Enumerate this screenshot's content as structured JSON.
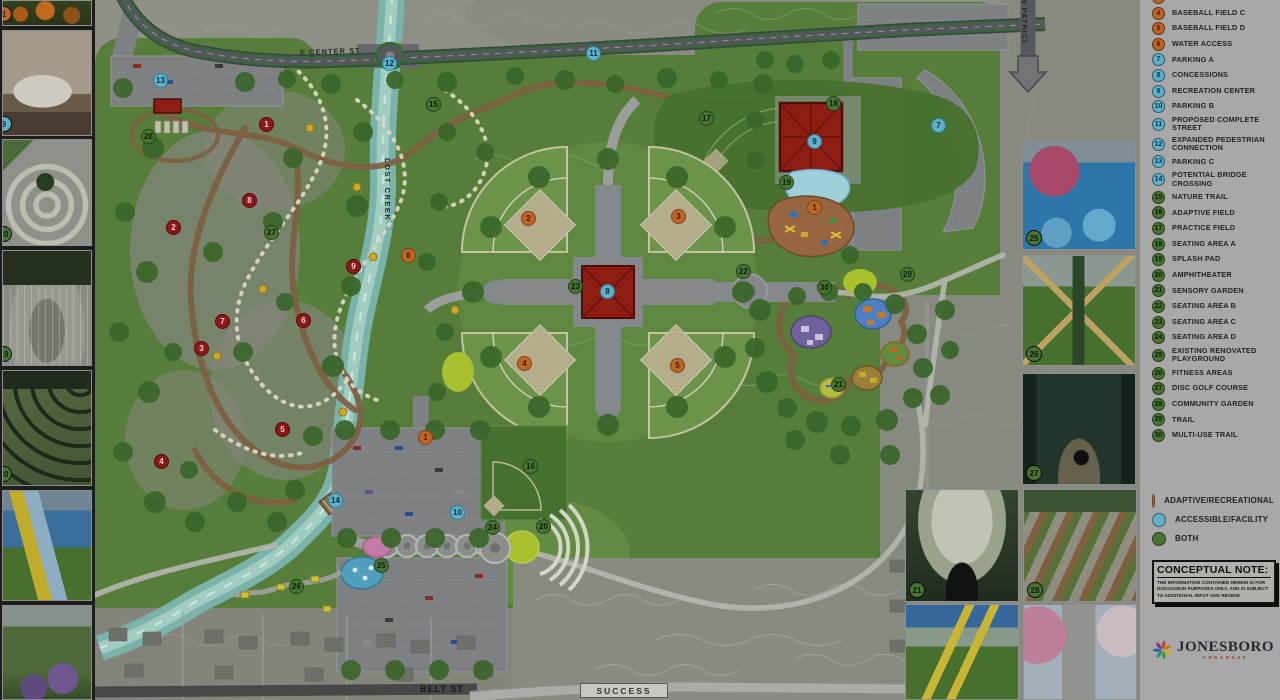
{
  "legend": {
    "items": [
      {
        "num": "3",
        "label": "BASEBALL FIELD B",
        "type": "adaptive"
      },
      {
        "num": "4",
        "label": "BASEBALL FIELD C",
        "type": "adaptive"
      },
      {
        "num": "5",
        "label": "BASEBALL FIELD D",
        "type": "adaptive"
      },
      {
        "num": "6",
        "label": "WATER ACCESS",
        "type": "adaptive"
      },
      {
        "num": "7",
        "label": "PARKING A",
        "type": "accessible"
      },
      {
        "num": "8",
        "label": "CONCESSIONS",
        "type": "accessible"
      },
      {
        "num": "9",
        "label": "RECREATION CENTER",
        "type": "accessible"
      },
      {
        "num": "10",
        "label": "PARKING B",
        "type": "accessible"
      },
      {
        "num": "11",
        "label": "PROPOSED COMPLETE STREET",
        "type": "accessible"
      },
      {
        "num": "12",
        "label": "EXPANDED PEDESTRIAN CONNECTION",
        "type": "accessible"
      },
      {
        "num": "13",
        "label": "PARKING C",
        "type": "accessible"
      },
      {
        "num": "14",
        "label": "POTENTIAL BRIDGE CROSSING",
        "type": "accessible"
      },
      {
        "num": "15",
        "label": "NATURE TRAIL",
        "type": "both"
      },
      {
        "num": "16",
        "label": "ADAPTIVE FIELD",
        "type": "both"
      },
      {
        "num": "17",
        "label": "PRACTICE FIELD",
        "type": "both"
      },
      {
        "num": "18",
        "label": "SEATING AREA A",
        "type": "both"
      },
      {
        "num": "19",
        "label": "SPLASH PAD",
        "type": "both"
      },
      {
        "num": "20",
        "label": "AMPHITHEATER",
        "type": "both"
      },
      {
        "num": "21",
        "label": "SENSORY GARDEN",
        "type": "both"
      },
      {
        "num": "22",
        "label": "SEATING AREA B",
        "type": "both"
      },
      {
        "num": "23",
        "label": "SEATING AREA C",
        "type": "both"
      },
      {
        "num": "24",
        "label": "SEATING AREA D",
        "type": "both"
      },
      {
        "num": "25",
        "label": "EXISTING RENOVATED PLAYGROUND",
        "type": "both"
      },
      {
        "num": "26",
        "label": "FITNESS AREAS",
        "type": "both"
      },
      {
        "num": "27",
        "label": "DISC GOLF COURSE",
        "type": "both"
      },
      {
        "num": "28",
        "label": "COMMUNITY GARDEN",
        "type": "both"
      },
      {
        "num": "29",
        "label": "TRAIL",
        "type": "both"
      },
      {
        "num": "30",
        "label": "MULTI-USE TRAIL",
        "type": "both"
      }
    ],
    "key": [
      {
        "label": "ADAPTIVE/RECREATIONAL",
        "color": "#bf6626",
        "type": "adaptive"
      },
      {
        "label": "ACCESSIBLE/FACILITY",
        "color": "#5fb0ca",
        "type": "accessible"
      },
      {
        "label": "BOTH",
        "color": "#4a7433",
        "type": "both"
      }
    ],
    "note": {
      "title": "CONCEPTUAL NOTE:",
      "body": "THE INFORMATION CONTAINED HEREIN IS FOR DISCUSSION PURPOSES ONLY, AND IS SUBJECT TO ADDITIONAL INPUT AND REVIEW"
    },
    "logo": {
      "name": "JONESBORO",
      "sub": "ARKANSAS"
    }
  },
  "map": {
    "street_labels": {
      "center_st": "E CENTER ST",
      "lost_creek": "LOST CREEK",
      "n_patrick": "N PATRICK ST",
      "belt_st": "BELT ST",
      "success": "SUCCESS"
    },
    "markers": {
      "facility": [
        {
          "n": "13",
          "x": 161,
          "y": 81
        },
        {
          "n": "12",
          "x": 390,
          "y": 64
        },
        {
          "n": "11",
          "x": 594,
          "y": 54
        },
        {
          "n": "8",
          "x": 608,
          "y": 292
        },
        {
          "n": "9",
          "x": 815,
          "y": 142
        },
        {
          "n": "7",
          "x": 939,
          "y": 126
        },
        {
          "n": "10",
          "x": 458,
          "y": 513
        },
        {
          "n": "14",
          "x": 336,
          "y": 501
        }
      ],
      "recreational": [
        {
          "n": "1",
          "x": 815,
          "y": 208
        },
        {
          "n": "2",
          "x": 529,
          "y": 219
        },
        {
          "n": "3",
          "x": 679,
          "y": 217
        },
        {
          "n": "4",
          "x": 525,
          "y": 364
        },
        {
          "n": "5",
          "x": 678,
          "y": 366
        },
        {
          "n": "6",
          "x": 409,
          "y": 256
        },
        {
          "n": "1",
          "x": 426,
          "y": 438
        }
      ],
      "both": [
        {
          "n": "15",
          "x": 434,
          "y": 105
        },
        {
          "n": "17",
          "x": 707,
          "y": 119
        },
        {
          "n": "18",
          "x": 834,
          "y": 104
        },
        {
          "n": "19",
          "x": 787,
          "y": 183
        },
        {
          "n": "22",
          "x": 744,
          "y": 272
        },
        {
          "n": "23",
          "x": 576,
          "y": 287
        },
        {
          "n": "29",
          "x": 908,
          "y": 275
        },
        {
          "n": "30",
          "x": 825,
          "y": 288
        },
        {
          "n": "21",
          "x": 839,
          "y": 385
        },
        {
          "n": "16",
          "x": 531,
          "y": 467
        },
        {
          "n": "24",
          "x": 493,
          "y": 528
        },
        {
          "n": "20",
          "x": 544,
          "y": 527
        },
        {
          "n": "25",
          "x": 382,
          "y": 566
        },
        {
          "n": "26",
          "x": 297,
          "y": 587
        },
        {
          "n": "28",
          "x": 149,
          "y": 137
        },
        {
          "n": "27",
          "x": 272,
          "y": 233
        }
      ],
      "disc_golf_holes": [
        {
          "n": "1",
          "x": 267,
          "y": 125
        },
        {
          "n": "2",
          "x": 174,
          "y": 228
        },
        {
          "n": "3",
          "x": 202,
          "y": 349
        },
        {
          "n": "4",
          "x": 162,
          "y": 462
        },
        {
          "n": "5",
          "x": 283,
          "y": 430
        },
        {
          "n": "6",
          "x": 304,
          "y": 321
        },
        {
          "n": "7",
          "x": 223,
          "y": 322
        },
        {
          "n": "8",
          "x": 250,
          "y": 201
        },
        {
          "n": "9",
          "x": 354,
          "y": 267
        }
      ]
    }
  },
  "photos": {
    "left": [
      {
        "name": "photo-nature-play",
        "style": "ph-nature",
        "x": 2,
        "y": 0,
        "w": 90,
        "h": 26,
        "badge": {
          "num": "1",
          "type": "adaptive",
          "cut": true
        }
      },
      {
        "name": "photo-changing-room",
        "style": "ph-room",
        "x": 2,
        "y": 30,
        "w": 90,
        "h": 106,
        "badge": {
          "num": "9",
          "type": "accessible",
          "cut": true
        }
      },
      {
        "name": "photo-spiral-garden",
        "style": "ph-spiral",
        "x": 2,
        "y": 139,
        "w": 90,
        "h": 107,
        "badge": {
          "num": "30",
          "type": "both",
          "cut": true
        }
      },
      {
        "name": "photo-splash-fountain",
        "style": "ph-fountain",
        "x": 2,
        "y": 250,
        "w": 90,
        "h": 116,
        "badge": {
          "num": "19",
          "type": "both",
          "cut": true
        }
      },
      {
        "name": "photo-amphitheater",
        "style": "ph-amphi",
        "x": 2,
        "y": 370,
        "w": 90,
        "h": 116,
        "badge": {
          "num": "20",
          "type": "both",
          "cut": true
        }
      },
      {
        "name": "photo-playground-slide",
        "style": "ph-slide",
        "x": 2,
        "y": 490,
        "w": 90,
        "h": 111,
        "badge": null
      },
      {
        "name": "photo-flower-garden",
        "style": "ph-flowers",
        "x": 2,
        "y": 605,
        "w": 90,
        "h": 95,
        "badge": null
      }
    ],
    "right": [
      {
        "name": "photo-renovated-playground",
        "style": "ph-renov",
        "x": 1022,
        "y": 140,
        "w": 114,
        "h": 110,
        "badge": {
          "num": "25",
          "type": "both"
        }
      },
      {
        "name": "photo-fitness-swings",
        "style": "ph-fitness",
        "x": 1022,
        "y": 255,
        "w": 114,
        "h": 111,
        "badge": {
          "num": "26",
          "type": "both"
        }
      },
      {
        "name": "photo-disc-golf",
        "style": "ph-disc",
        "x": 1022,
        "y": 373,
        "w": 114,
        "h": 112,
        "badge": {
          "num": "27",
          "type": "both"
        }
      },
      {
        "name": "photo-garden-bench",
        "style": "ph-bench",
        "x": 905,
        "y": 489,
        "w": 114,
        "h": 113,
        "badge": {
          "num": "21",
          "type": "both"
        }
      },
      {
        "name": "photo-community-garden",
        "style": "ph-beds",
        "x": 1023,
        "y": 489,
        "w": 114,
        "h": 113,
        "badge": {
          "num": "28",
          "type": "both"
        }
      },
      {
        "name": "photo-adaptive-swing",
        "style": "ph-swing",
        "x": 905,
        "y": 604,
        "w": 114,
        "h": 96,
        "badge": null
      },
      {
        "name": "photo-blossom-path",
        "style": "ph-blossom",
        "x": 1023,
        "y": 604,
        "w": 114,
        "h": 96,
        "badge": null
      }
    ]
  },
  "colors": {
    "adaptive": "#bf6626",
    "accessible": "#5fb0ca",
    "both": "#4a7433",
    "disc_golf": "#8e1818",
    "creek": "#7ab3a9",
    "legend_bg": "#a8a8a8",
    "building": "#8e1d14"
  }
}
